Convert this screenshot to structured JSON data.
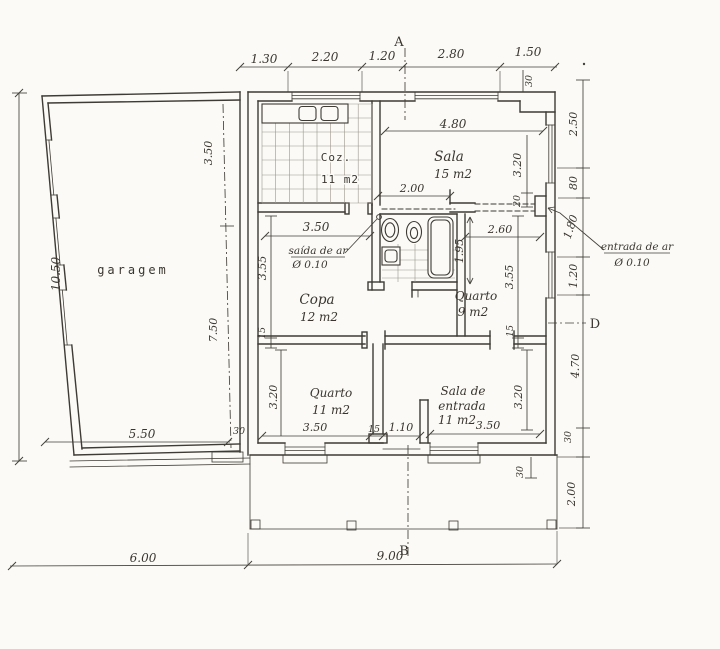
{
  "colors": {
    "ink": "#3e3a34",
    "paper": "#fbfaf6"
  },
  "markers": {
    "a": "A",
    "b": "B",
    "d": "D"
  },
  "rooms": {
    "garagem": {
      "label": "garagem"
    },
    "coz": {
      "label": "Coz.",
      "area": "11 m2"
    },
    "sala": {
      "label": "Sala",
      "area": "15 m2"
    },
    "copa": {
      "label": "Copa",
      "area": "12 m2"
    },
    "quarto9": {
      "label": "Quarto",
      "area": "9 m2"
    },
    "quarto11": {
      "label": "Quarto",
      "area": "11 m2"
    },
    "entrada": {
      "label1": "Sala de",
      "label2": "entrada",
      "area": "11 m2"
    }
  },
  "vents": {
    "saida": {
      "line1": "saída de ar",
      "line2": "Ø 0.10"
    },
    "entrada": {
      "line1": "entrada de ar",
      "line2": "Ø 0.10"
    }
  },
  "dims": {
    "top": {
      "d1": "1.30",
      "d2": "2.20",
      "d3": "1.20",
      "d4": "2.80",
      "d5": "1.50",
      "wall": "30"
    },
    "left": {
      "total": "10.50"
    },
    "right": {
      "r1": "2.50",
      "r2": "80",
      "r3": "1.80",
      "r4": "1.20",
      "r5": "4.70",
      "r6": "30",
      "r7": "2.00"
    },
    "bottom": {
      "b1": "6.00",
      "b2": "9.00",
      "step": "30"
    },
    "garage": {
      "top": "3.50",
      "bottom": "7.50",
      "width": "5.50",
      "wall": "30"
    },
    "sala": {
      "width": "4.80",
      "height": "3.20",
      "wall": "20",
      "door": "2.00"
    },
    "copa": {
      "width": "3.50",
      "height": "3.55",
      "wall": "15"
    },
    "bath": {
      "depth": "1.95"
    },
    "quarto9": {
      "width": "2.60",
      "height": "3.55",
      "wall": "15"
    },
    "quarto11": {
      "width": "3.50",
      "height": "3.20",
      "wall": "15",
      "hall": "1.10"
    },
    "entrada": {
      "width": "3.50",
      "height": "3.20"
    }
  }
}
